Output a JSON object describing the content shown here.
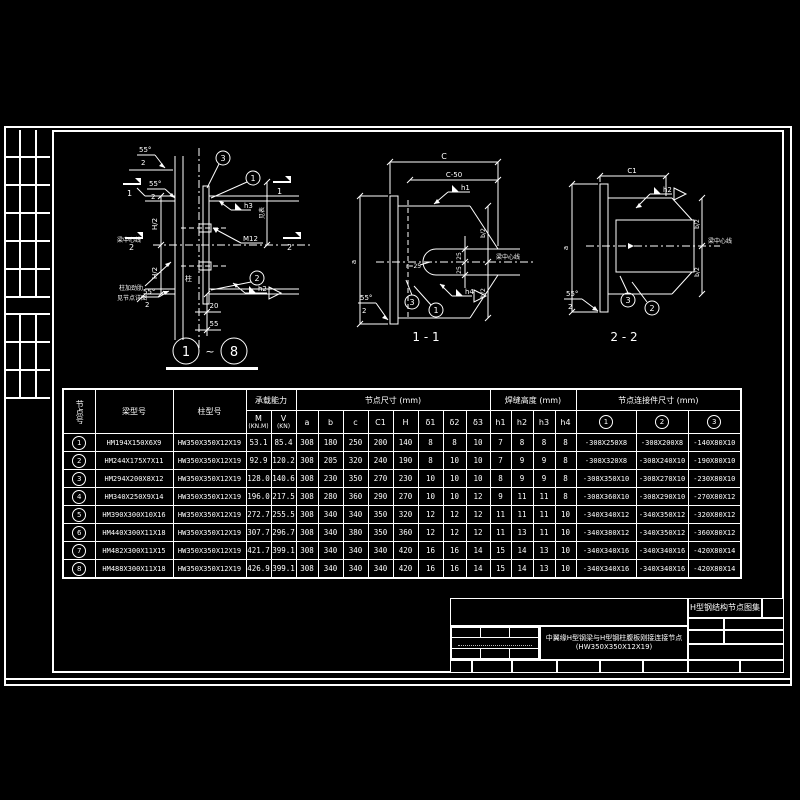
{
  "title_block": {
    "atlas": "H型钢结构节点图集",
    "drawing_title_line1": "中翼缘H型钢梁与H型钢柱腹板刚接连接节点",
    "drawing_title_line2": "(HW350X350X12X19)"
  },
  "drawings": {
    "detail": {
      "title_ref_start": "1",
      "title_ref_end": "8",
      "tilde": "~",
      "labels": {
        "angle1": "55°",
        "angle1_den": "2",
        "angle2": "55°",
        "angle2_den": "2",
        "angle3": "55°",
        "angle3_den": "2",
        "beam_centerline": "梁中心线",
        "h_half_top": "H/2",
        "h_half_bot": "H/2",
        "column": "柱",
        "stiffener_line1": "柱加劲肋",
        "stiffener_line2": "见节点详图",
        "weld_h3": "h3",
        "weld_h2": "h2",
        "bolt": "M12",
        "dim_top": "20",
        "dim_bot": "55",
        "dim_right": "见表",
        "ref1": "1",
        "ref2": "2",
        "ref3": "3",
        "sec1_left": "1",
        "sec1_right": "1",
        "sec2_left": "2",
        "sec2_right": "2"
      }
    },
    "section11": {
      "title": "1 - 1",
      "labels": {
        "dim_c": "C",
        "dim_c50": "C-50",
        "dim_a": "a",
        "weld_h1": "h1",
        "weld_h4": "h4",
        "dim_25_top": "25",
        "dim_25_bot": "25",
        "radius": "r=25",
        "b_half_top": "b/2",
        "b_half_bot": "b/2",
        "beam_centerline": "梁中心线",
        "angle": "55°",
        "angle_den": "2",
        "ref3": "3",
        "ref1": "1"
      }
    },
    "section22": {
      "title": "2 - 2",
      "labels": {
        "dim_c1": "C1",
        "dim_a": "a",
        "weld_h2": "h2",
        "b_half_top": "b/2",
        "b_half_bot": "b/2",
        "beam_centerline": "梁中心线",
        "angle": "55°",
        "angle_den": "2",
        "ref3": "3",
        "ref2": "2"
      }
    }
  },
  "table": {
    "headers": {
      "node": "节点号",
      "beam": "梁型号",
      "column": "柱型号",
      "capacity": "承载能力",
      "capacity_m": "M",
      "capacity_m_unit": "(KN.M)",
      "capacity_v": "V",
      "capacity_v_unit": "(KN)",
      "node_size": "节点尺寸 (mm)",
      "size_cols": [
        "a",
        "b",
        "c",
        "C1",
        "H",
        "δ1",
        "δ2",
        "δ3"
      ],
      "weld": "焊缝高度 (mm)",
      "weld_cols": [
        "h1",
        "h2",
        "h3",
        "h4"
      ],
      "connector": "节点连接件尺寸 (mm)",
      "connector_cols": [
        "1",
        "2",
        "3"
      ]
    },
    "rows": [
      {
        "no": "1",
        "beam": "HM194X150X6X9",
        "col": "HW350X350X12X19",
        "m": "53.1",
        "v": "85.4",
        "size": [
          "308",
          "180",
          "250",
          "200",
          "140",
          "8",
          "8",
          "10"
        ],
        "weld": [
          "7",
          "8",
          "8",
          "8"
        ],
        "conn": [
          "-308X250X8",
          "-308X200X8",
          "-140X80X10"
        ]
      },
      {
        "no": "2",
        "beam": "HM244X175X7X11",
        "col": "HW350X350X12X19",
        "m": "92.9",
        "v": "120.2",
        "size": [
          "308",
          "205",
          "320",
          "240",
          "190",
          "8",
          "10",
          "10"
        ],
        "weld": [
          "7",
          "9",
          "9",
          "8"
        ],
        "conn": [
          "-308X320X8",
          "-308X240X10",
          "-190X80X10"
        ]
      },
      {
        "no": "3",
        "beam": "HM294X200X8X12",
        "col": "HW350X350X12X19",
        "m": "128.0",
        "v": "140.6",
        "size": [
          "308",
          "230",
          "350",
          "270",
          "230",
          "10",
          "10",
          "10"
        ],
        "weld": [
          "8",
          "9",
          "9",
          "8"
        ],
        "conn": [
          "-308X350X10",
          "-308X270X10",
          "-230X80X10"
        ]
      },
      {
        "no": "4",
        "beam": "HM340X250X9X14",
        "col": "HW350X350X12X19",
        "m": "196.0",
        "v": "217.5",
        "size": [
          "308",
          "280",
          "360",
          "290",
          "270",
          "10",
          "10",
          "12"
        ],
        "weld": [
          "9",
          "11",
          "11",
          "8"
        ],
        "conn": [
          "-308X360X10",
          "-308X290X10",
          "-270X80X12"
        ]
      },
      {
        "no": "5",
        "beam": "HM390X300X10X16",
        "col": "HW350X350X12X19",
        "m": "272.7",
        "v": "255.5",
        "size": [
          "308",
          "340",
          "340",
          "350",
          "320",
          "12",
          "12",
          "12"
        ],
        "weld": [
          "11",
          "11",
          "11",
          "10"
        ],
        "conn": [
          "-340X340X12",
          "-340X350X12",
          "-320X80X12"
        ]
      },
      {
        "no": "6",
        "beam": "HM440X300X11X18",
        "col": "HW350X350X12X19",
        "m": "307.7",
        "v": "296.7",
        "size": [
          "308",
          "340",
          "380",
          "350",
          "360",
          "12",
          "12",
          "12"
        ],
        "weld": [
          "11",
          "13",
          "11",
          "10"
        ],
        "conn": [
          "-340X380X12",
          "-340X350X12",
          "-360X80X12"
        ]
      },
      {
        "no": "7",
        "beam": "HM482X300X11X15",
        "col": "HW350X350X12X19",
        "m": "421.7",
        "v": "399.1",
        "size": [
          "308",
          "340",
          "340",
          "340",
          "420",
          "16",
          "16",
          "14"
        ],
        "weld": [
          "15",
          "14",
          "13",
          "10"
        ],
        "conn": [
          "-340X340X16",
          "-340X340X16",
          "-420X80X14"
        ]
      },
      {
        "no": "8",
        "beam": "HM488X300X11X18",
        "col": "HW350X350X12X19",
        "m": "426.9",
        "v": "399.1",
        "size": [
          "308",
          "340",
          "340",
          "340",
          "420",
          "16",
          "16",
          "14"
        ],
        "weld": [
          "15",
          "14",
          "13",
          "10"
        ],
        "conn": [
          "-340X340X16",
          "-340X340X16",
          "-420X80X14"
        ]
      }
    ]
  }
}
